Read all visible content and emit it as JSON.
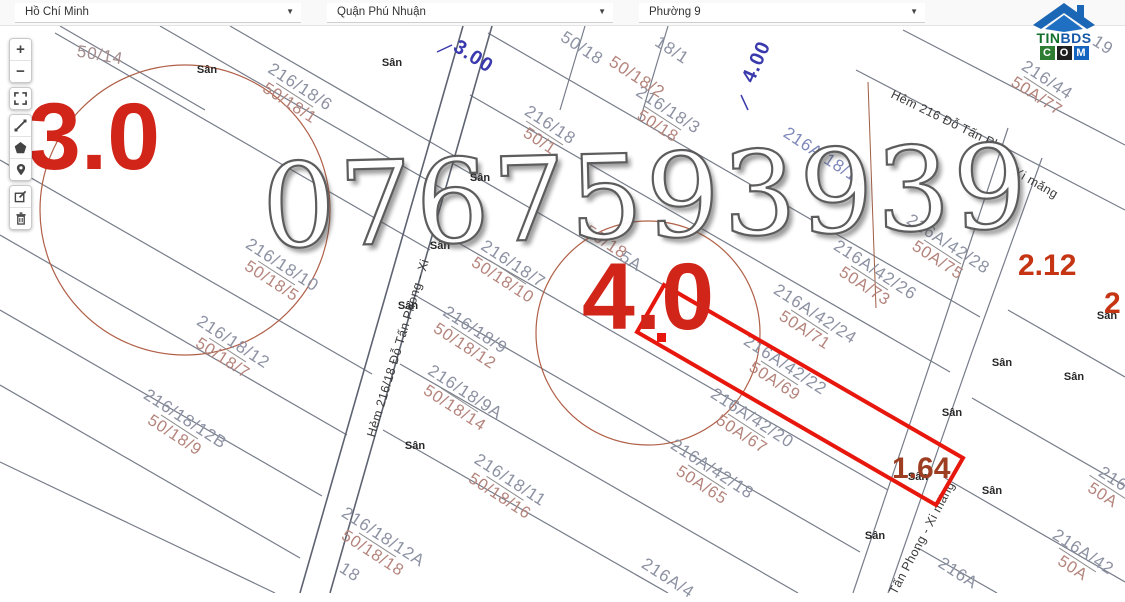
{
  "header": {
    "selects": [
      {
        "value": "Hồ Chí Minh"
      },
      {
        "value": "Quận Phú Nhuận"
      },
      {
        "value": "Phường 9"
      }
    ]
  },
  "logo": {
    "title1": "TIN",
    "title2": "BDS",
    "sub": [
      "C",
      "O",
      "M"
    ]
  },
  "toolbar": {
    "buttons": [
      "zoom-in",
      "zoom-out",
      "fullscreen",
      "measure-line",
      "draw-polygon",
      "marker",
      "edit",
      "delete"
    ]
  },
  "map": {
    "watermark": "0767593939",
    "yard_text": "Sân",
    "parcels": [
      {
        "l1": "216/18/6",
        "l2": "50/18/1",
        "x": 295,
        "y": 95
      },
      {
        "l1": "216/18",
        "l2": "50/1",
        "x": 545,
        "y": 133
      },
      {
        "l1": "216/18/3",
        "l2": "50/18",
        "x": 663,
        "y": 118
      },
      {
        "l1": "216/18/7",
        "l2": "50/18/10",
        "x": 508,
        "y": 272
      },
      {
        "l1": "216/18/9",
        "l2": "50/18/12",
        "x": 470,
        "y": 338
      },
      {
        "l1": "216/18/9A",
        "l2": "50/18/14",
        "x": 460,
        "y": 400
      },
      {
        "l1": "216/18/11",
        "l2": "50/18/16",
        "x": 505,
        "y": 488
      },
      {
        "l1": "216/18/12A",
        "l2": "50/18/18",
        "x": 378,
        "y": 545
      },
      {
        "l1": "216/18/10",
        "l2": "50/18/5",
        "x": 277,
        "y": 273
      },
      {
        "l1": "216/18/12",
        "l2": "50/18/7",
        "x": 228,
        "y": 350
      },
      {
        "l1": "216/18/12B",
        "l2": "50/18/9",
        "x": 180,
        "y": 427
      },
      {
        "l1": "216A/42/28",
        "l2": "50A/75",
        "x": 943,
        "y": 252
      },
      {
        "l1": "216A/42/26",
        "l2": "50A/73",
        "x": 870,
        "y": 278
      },
      {
        "l1": "216A/42/24",
        "l2": "50A/71",
        "x": 810,
        "y": 322
      },
      {
        "l1": "216A/42/22",
        "l2": "50A/69",
        "x": 780,
        "y": 373
      },
      {
        "l1": "216A/42/20",
        "l2": "50A/67",
        "x": 747,
        "y": 426
      },
      {
        "l1": "216A/42/18",
        "l2": "50A/65",
        "x": 707,
        "y": 477
      },
      {
        "l1": "216/44",
        "l2": "50A/77",
        "x": 1042,
        "y": 88
      },
      {
        "l1": "216A/42",
        "l2": "50A",
        "x": 1078,
        "y": 560
      },
      {
        "l1": "216",
        "l2": "50A",
        "x": 1108,
        "y": 487
      },
      {
        "l1": "216A",
        "l2": "",
        "x": 958,
        "y": 573
      },
      {
        "l1": "216A/4",
        "l2": "",
        "x": 668,
        "y": 578
      },
      {
        "l1": "216A/18/10",
        "l2": "",
        "x": 825,
        "y": 157,
        "c1": "#7f88bb"
      },
      {
        "l1": "50/14",
        "l2": "",
        "x": 100,
        "y": 55,
        "rot": 10,
        "c1": "#a68d8d"
      },
      {
        "l1": "50/18",
        "l2": "",
        "x": 582,
        "y": 48
      },
      {
        "l1": "18/1",
        "l2": "",
        "x": 672,
        "y": 50
      },
      {
        "l1": "50/18/2",
        "l2": "",
        "x": 637,
        "y": 77,
        "c1": "#b4847c"
      },
      {
        "l1": "50/18",
        "l2": "",
        "x": 606,
        "y": 242,
        "c1": "#b4847c"
      },
      {
        "l1": "5A",
        "l2": "",
        "x": 631,
        "y": 261
      },
      {
        "l1": "19",
        "l2": "",
        "x": 1103,
        "y": 45
      },
      {
        "l1": "18",
        "l2": "",
        "x": 350,
        "y": 572
      }
    ],
    "streets": [
      {
        "text": "Hẻm 216/18 Đỗ Tấn Phong - Xi",
        "x": 398,
        "y": 348,
        "rot": -73
      },
      {
        "text": "Hẻm 216 Đỗ Tấn Ph",
        "x": 946,
        "y": 120,
        "rot": 26
      },
      {
        "text": "Xi măng",
        "x": 1036,
        "y": 183,
        "rot": 30
      },
      {
        "text": "Tấn Phong - Xi măng",
        "x": 922,
        "y": 538,
        "rot": -62
      }
    ],
    "yards": [
      {
        "x": 207,
        "y": 70
      },
      {
        "x": 392,
        "y": 63
      },
      {
        "x": 480,
        "y": 178
      },
      {
        "x": 440,
        "y": 246
      },
      {
        "x": 408,
        "y": 306
      },
      {
        "x": 415,
        "y": 446
      },
      {
        "x": 952,
        "y": 413
      },
      {
        "x": 918,
        "y": 477
      },
      {
        "x": 992,
        "y": 491
      },
      {
        "x": 875,
        "y": 536
      },
      {
        "x": 1074,
        "y": 377
      },
      {
        "x": 1107,
        "y": 316
      },
      {
        "x": 1002,
        "y": 363
      }
    ],
    "dimensions": [
      {
        "text": "3.00",
        "x": 473,
        "y": 57,
        "rot": 33
      },
      {
        "text": "4.00",
        "x": 757,
        "y": 62,
        "rot": -66
      }
    ],
    "red_numbers": [
      {
        "text": "3.0",
        "x": 28,
        "y": 92,
        "size": 95,
        "color": "#d2251a"
      },
      {
        "text": "4.0",
        "x": 582,
        "y": 252,
        "size": 95,
        "color": "#d2251a"
      },
      {
        "text": "2.12",
        "x": 1018,
        "y": 252,
        "size": 30,
        "color": "#c53413"
      },
      {
        "text": "1.64",
        "x": 892,
        "y": 455,
        "size": 30,
        "color": "#9d3d22"
      },
      {
        "text": "2",
        "x": 1104,
        "y": 290,
        "size": 30,
        "color": "#c53413"
      }
    ]
  }
}
